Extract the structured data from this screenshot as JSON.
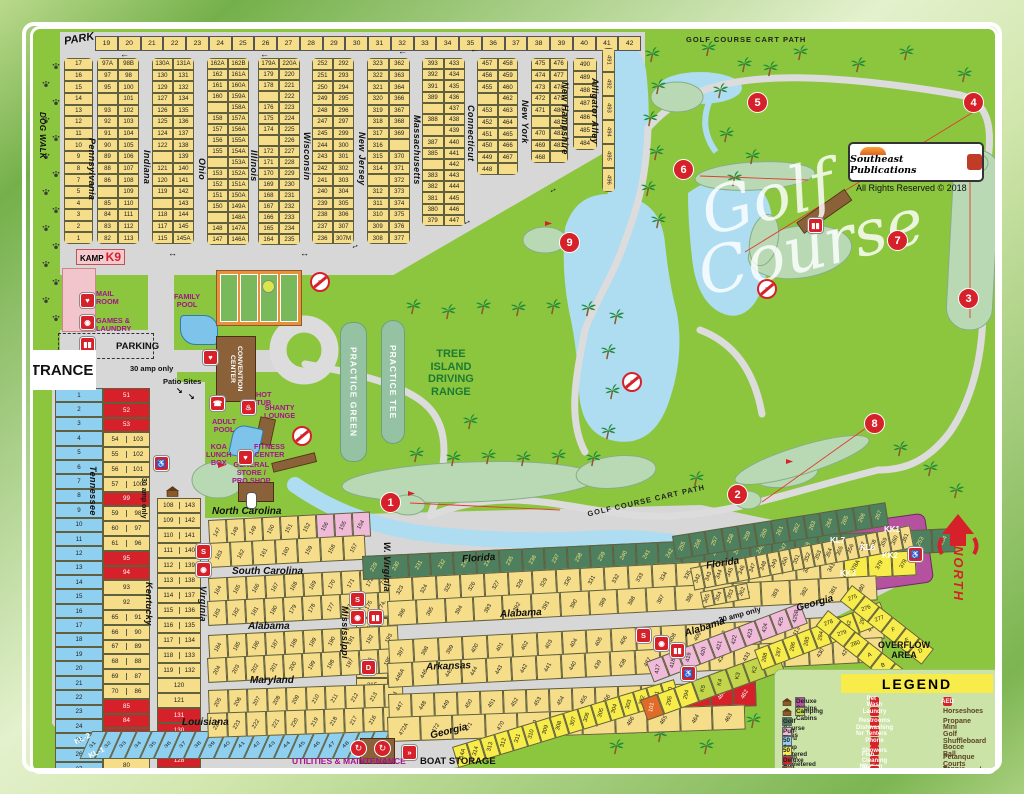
{
  "labels": {
    "park": "PARK",
    "dog_walk": "DOG WALK",
    "rhode_island": "Rhode Island",
    "michigan": "Michigan",
    "entrance": "ENTRANCE",
    "office": "OFFICE",
    "parking": "PARKING",
    "kamp": "KAMP",
    "k9": "K9",
    "mail_room": "MAIL\nROOM",
    "games_laundry": "GAMES &\nLAUNDRY",
    "family_pool": "FAMILY\nPOOL",
    "convention": "CONVENTION CENTER",
    "hot_tub": "HOT\nTUB",
    "shanty": "SHANTY\nLOUNGE",
    "adult_pool": "ADULT\nPOOL",
    "koa_lunch": "KOA\nLUNCH\nBOX",
    "fitness": "FITNESS\nCENTER",
    "general_store": "GENERAL\nSTORE /\nPRO SHOP",
    "practice_green": "PRACTICE GREEN",
    "practice_tee": "PRACTICE TEE",
    "range": "TREE\nISLAND\nDRIVING\nRANGE",
    "golf_script1": "Golf",
    "golf_script2": "Course",
    "cart_path": "GOLF COURSE CART PATH",
    "publisher": "Southeast Publications",
    "rights": "All Rights Reserved © 2018",
    "north": "NORTH",
    "overflow": "OVERFLOW\nAREA",
    "utilities": "UTILITIES & MAINTENANCE",
    "boat": "BOAT STORAGE",
    "patio": "Patio Sites",
    "amp30": "30 amp only",
    "legend_title": "LEGEND"
  },
  "streets": {
    "pennsylvania": "Pennsylvania",
    "indiana": "Indiana",
    "ohio": "Ohio",
    "illinois": "Illinois",
    "wisconsin": "Wisconsin",
    "new_jersey": "New Jersey",
    "massachusetts": "Massachusetts",
    "connecticut": "Connecticut",
    "new_york": "New York",
    "new_hampshire": "New Hampshire",
    "alligator_alley": "Alligator Alley",
    "tennessee": "Tennessee",
    "kentucky": "Kentucky",
    "virginia": "Virginia",
    "mississippi": "Mississippi",
    "w_virginia": "W. Virginia",
    "north_carolina": "North Carolina",
    "south_carolina": "South Carolina",
    "alabama": "Alabama",
    "maryland": "Maryland",
    "louisiana": "Louisiana",
    "florida": "Florida",
    "arkansas": "Arkansas",
    "georgia": "Georgia"
  },
  "top_grid": {
    "col_headers": [
      "19",
      "20",
      "21",
      "22",
      "23",
      "24",
      "25",
      "26",
      "27",
      "28",
      "29",
      "30",
      "31",
      "32",
      "33",
      "34",
      "35",
      "36",
      "37",
      "38",
      "39",
      "40",
      "41",
      "42"
    ],
    "row_numbers": [
      "17",
      "16",
      "15",
      "14",
      "13",
      "12",
      "11",
      "10",
      "9",
      "8",
      "7",
      "5",
      "4",
      "3",
      "2",
      "1"
    ],
    "pa": [
      "97A|98B",
      "97|98",
      "95|100",
      "|101",
      "93|102",
      "92|103",
      "91|104",
      "90|105",
      "89|106",
      "88|107",
      "86|108",
      "|109",
      "85|110",
      "84|111",
      "83|112",
      "82|113"
    ],
    "in": [
      "130A|131A",
      "130|131",
      "129|132",
      "127|134",
      "126|135",
      "125|136",
      "124|137",
      "122|138",
      "|139",
      "121|140",
      "120|141",
      "119|142",
      "|143",
      "118|144",
      "117|145",
      "115|145A"
    ],
    "oh": [
      "162A|162B",
      "162|161A",
      "161|160A",
      "160|159A",
      "|158A",
      "158|157A",
      "157|156A",
      "156|155A",
      "155|154A",
      "|153A",
      "153|152A",
      "152|151A",
      "151|150A",
      "150|149A",
      "|148A",
      "148|147A",
      "147|146A"
    ],
    "il": [
      "179A|220A",
      "179|220",
      "178|221",
      "|222",
      "176|223",
      "175|224",
      "174|225",
      "|226",
      "172|227",
      "171|228",
      "170|229",
      "169|230",
      "168|231",
      "167|232",
      "166|233",
      "165|234",
      "164|235"
    ],
    "wi": [
      "252|292",
      "251|293",
      "250|294",
      "249|295",
      "248|296",
      "247|297",
      "245|299",
      "244|300",
      "243|301",
      "242|302",
      "241|303",
      "240|304",
      "239|305",
      "238|306",
      "237|307",
      "236|307M"
    ],
    "nj": [
      "323|362",
      "322|363",
      "321|364",
      "320|366",
      "319|367",
      "318|368",
      "317|369",
      "316|",
      "315|370",
      "314|371",
      "|372",
      "312|373",
      "311|374",
      "310|375",
      "309|376",
      "308|377"
    ],
    "ma": [
      "393|433",
      "392|434",
      "391|435",
      "389|436",
      "|437",
      "388|438",
      "|439",
      "387|440",
      "385|441",
      "|442",
      "383|443",
      "382|444",
      "381|445",
      "380|446",
      "379|447"
    ],
    "ct": [
      "457|458",
      "456|459",
      "455|460",
      "|462",
      "453|463",
      "452|464",
      "451|465",
      "450|466",
      "449|467",
      "448|"
    ],
    "ny": [
      "475|476",
      "474|477",
      "473|478",
      "472|479",
      "471|480",
      "|481",
      "470|482",
      "469|483",
      "468|"
    ],
    "nh": [
      "490",
      "489",
      "488",
      "487",
      "486",
      "485",
      "484"
    ],
    "aa": [
      "491",
      "492",
      "493",
      "494",
      "495",
      "496"
    ]
  },
  "west": {
    "tennessee": [
      "1",
      "2",
      "3",
      "4",
      "5",
      "6",
      "7",
      "8",
      "9",
      "10",
      "11",
      "12",
      "13",
      "14",
      "15",
      "16",
      "17",
      "18",
      "19",
      "20",
      "21",
      "22",
      "23",
      "24",
      "25",
      "26",
      "27",
      "28"
    ],
    "kentucky": [
      "51*r",
      "52*r",
      "53*r",
      "54|103",
      "55|102",
      "56|101",
      "57|100",
      "99*r",
      "59|98",
      "60|97",
      "61|96",
      "95*r",
      "94*r",
      "93",
      "92",
      "65|91",
      "66|90",
      "67|89",
      "68|88",
      "69|87",
      "70|86",
      "85*r",
      "84*r",
      "83*r",
      "81",
      "80",
      "79"
    ],
    "virginia": [
      "108|143",
      "109|142",
      "110|141",
      "111|140",
      "112|139",
      "113|138",
      "114|137",
      "115|136",
      "116|135",
      "117|134",
      "118|133",
      "119|132",
      "120",
      "121",
      "131*r",
      "130*r",
      "129*r",
      "128*r",
      "127",
      "126A|126B"
    ],
    "louisiana": [
      "31",
      "32",
      "33",
      "34",
      "35",
      "36",
      "37",
      "38",
      "39",
      "40",
      "41",
      "42",
      "43",
      "44",
      "45",
      "46",
      "47",
      "48",
      "49",
      "50"
    ],
    "kl": [
      "KL-2",
      "KL-1"
    ]
  },
  "mid": {
    "nc_top": [
      "147",
      "148",
      "149",
      "150",
      "151",
      "152",
      "156*p",
      "155*p",
      "154*p"
    ],
    "nc_bot": [
      "163",
      "162",
      "161",
      "160",
      "159",
      "158",
      "157"
    ],
    "sc_top": [
      "164",
      "165",
      "166",
      "167",
      "168",
      "169",
      "170",
      "171",
      "172",
      "173A|173B"
    ],
    "sc_bot": [
      "183",
      "182",
      "181",
      "180",
      "179",
      "178",
      "177",
      "176",
      "175",
      "174B|174A"
    ],
    "alw_top": [
      "184",
      "185",
      "186",
      "187",
      "188",
      "189",
      "190",
      "191",
      "192",
      "193"
    ],
    "alw_bot": [
      "204",
      "203",
      "202",
      "201",
      "200",
      "199",
      "198",
      "197",
      "196",
      "195"
    ],
    "md_top": [
      "205",
      "206",
      "207",
      "208",
      "209",
      "210",
      "211",
      "212",
      "213",
      "214"
    ],
    "md_bot": [
      "224",
      "223",
      "222",
      "221",
      "220",
      "219",
      "218",
      "217",
      "216",
      "215"
    ],
    "ms_cells": [
      "319",
      "320",
      "318",
      "321",
      "317B|317",
      "316B|316",
      "315"
    ]
  },
  "se": {
    "golf_w": [
      "229",
      "230",
      "231",
      "232",
      "233",
      "234",
      "235",
      "236",
      "237",
      "238",
      "239",
      "240",
      "241",
      "242",
      "243",
      "244",
      "245",
      "246",
      "247",
      "248",
      "249",
      "250",
      "251",
      "252",
      "253",
      "254"
    ],
    "golf_e": [
      "255",
      "256",
      "257",
      "258",
      "259",
      "260",
      "261",
      "262",
      "263",
      "264",
      "265",
      "266",
      "267"
    ],
    "florida_w_top": [
      "323",
      "324",
      "325",
      "326",
      "327",
      "328",
      "329",
      "330",
      "331",
      "332",
      "333",
      "334",
      "335",
      "336",
      "337",
      "338",
      "339",
      "340",
      "341",
      "378A*y2",
      "379*y2",
      "378*y2"
    ],
    "florida_w_bot": [
      "396",
      "395",
      "394",
      "393",
      "392",
      "391",
      "390",
      "389",
      "388",
      "387",
      "386",
      "385",
      "384",
      "383",
      "382",
      "381",
      "380"
    ],
    "florida_e_top": [
      "342",
      "343",
      "344",
      "345",
      "346",
      "347",
      "348",
      "349",
      "350",
      "351",
      "352",
      "353",
      "354",
      "355",
      "356",
      "357",
      "358",
      "359",
      "360",
      "361"
    ],
    "florida_e_bot": [
      "365",
      "364",
      "363",
      "362"
    ],
    "al2_top": [
      "397",
      "398",
      "399",
      "400",
      "401",
      "402",
      "403",
      "404",
      "405",
      "406",
      "407",
      "408",
      "409",
      "410",
      "411",
      "412",
      "413",
      "414",
      "415",
      "416"
    ],
    "al2_bot": [
      "446A",
      "446",
      "445",
      "444",
      "443",
      "442",
      "441",
      "440",
      "439",
      "438",
      "437",
      "436",
      "435",
      "434",
      "433",
      "432",
      "431",
      "430",
      "429",
      "428"
    ],
    "pink": [
      "417*p",
      "418*p",
      "419*p",
      "420*p",
      "421*p",
      "422*p",
      "423*p",
      "424*p",
      "425*p",
      "425B*p"
    ],
    "ark_top": [
      "447",
      "448",
      "449",
      "450",
      "451",
      "452",
      "453",
      "454",
      "455",
      "456",
      "457",
      "458",
      "459",
      "460*r",
      "461*r",
      "462*r"
    ],
    "ark_bot": [
      "472A",
      "472",
      "471",
      "470",
      "469",
      "468",
      "467",
      "466",
      "465",
      "464",
      "463"
    ],
    "georgia_diag": [
      "314A*y2",
      "314*y2",
      "313*y2",
      "312*y2",
      "311*y2",
      "310*y2",
      "309*y2",
      "308*y2",
      "307*y2",
      "306*y2",
      "305*y2",
      "304*y2",
      "303*y2",
      "302*y2",
      "301*y2",
      "300*y2"
    ],
    "k_row": [
      "101*o",
      "295*y2",
      "294*y2",
      "K5*lg",
      "K4*lg",
      "K3*lg",
      "K2*lg",
      "K1*lg"
    ],
    "e280": [
      "288*y2",
      "287*y2",
      "286*y2",
      "285*y2",
      "284*y2",
      "283*y2",
      "282*y2",
      "281*y2",
      "280*y2"
    ],
    "e275": [
      "275*y2",
      "276*y2",
      "277*y2",
      "F*y2",
      "E*y2",
      "D*y2"
    ],
    "eabc": [
      "278*y2",
      "279*y2",
      "280*y2",
      "A*y2",
      "B*y2",
      "C*y2"
    ],
    "kk": [
      "KL7",
      "KL6",
      "KK1",
      "KK2",
      "KK3"
    ]
  },
  "holes": [
    "1",
    "2",
    "3",
    "4",
    "5",
    "6",
    "7",
    "8",
    "9"
  ],
  "legend": {
    "site_types": [
      {
        "label": "Deluxe Cabins",
        "color": "#b5519e",
        "cabin": true
      },
      {
        "label": "Camping Cabins",
        "color": "#c3d54a",
        "cabin": true
      },
      {
        "label": "Golf Course Sites",
        "color": "#4e7f5e"
      },
      {
        "label": "Pull-Thru",
        "color": "#f0bbd8"
      },
      {
        "label": "50 Amp Metered",
        "color": "#8fd0f0"
      },
      {
        "label": "50 Amp Unmetered",
        "color": "#f7ec4a"
      },
      {
        "label": "Deluxe Pull Thru",
        "color": "#d6212a"
      },
      {
        "label": "Tent Site",
        "color": "#e06a28"
      },
      {
        "label": "Handicap Accessible",
        "color": "#d6212a",
        "glyph": "♿"
      }
    ],
    "amenities": [
      {
        "label": "Pet Wash",
        "glyph": "P"
      },
      {
        "label": "Laundry",
        "glyph": "◉"
      },
      {
        "label": "Restrooms",
        "glyph": "▮▮"
      },
      {
        "label": "Dishwashing for Tenters",
        "glyph": "D"
      },
      {
        "label": "Phone",
        "glyph": "☎"
      },
      {
        "label": "Showers",
        "glyph": "S"
      },
      {
        "label": "Fish Cleaning Station",
        "glyph": "»"
      },
      {
        "label": "No Swimming",
        "glyph": "⊘"
      },
      {
        "label": "Aluminum Can Recycling",
        "glyph": "↻"
      },
      {
        "label": "Paper Recycling",
        "glyph": "↻"
      }
    ],
    "activities": [
      {
        "label": "AED",
        "glyph": "♥",
        "red": true
      },
      {
        "label": "Horseshoes",
        "glyph": "∩"
      },
      {
        "label": "Propane",
        "glyph": "▯"
      },
      {
        "label": "Mini Golf",
        "glyph": "⌖"
      },
      {
        "label": "Shuffleboard",
        "glyph": "≣"
      },
      {
        "label": "Bocce Ball",
        "glyph": "◉"
      },
      {
        "label": "Petanque Courts",
        "glyph": "◎"
      },
      {
        "label": "Playground",
        "glyph": "▲"
      },
      {
        "label": "Tennis & Pickleball Courts",
        "glyph": "※"
      },
      {
        "label": "Campfire Ring",
        "glyph": "▲"
      }
    ]
  }
}
